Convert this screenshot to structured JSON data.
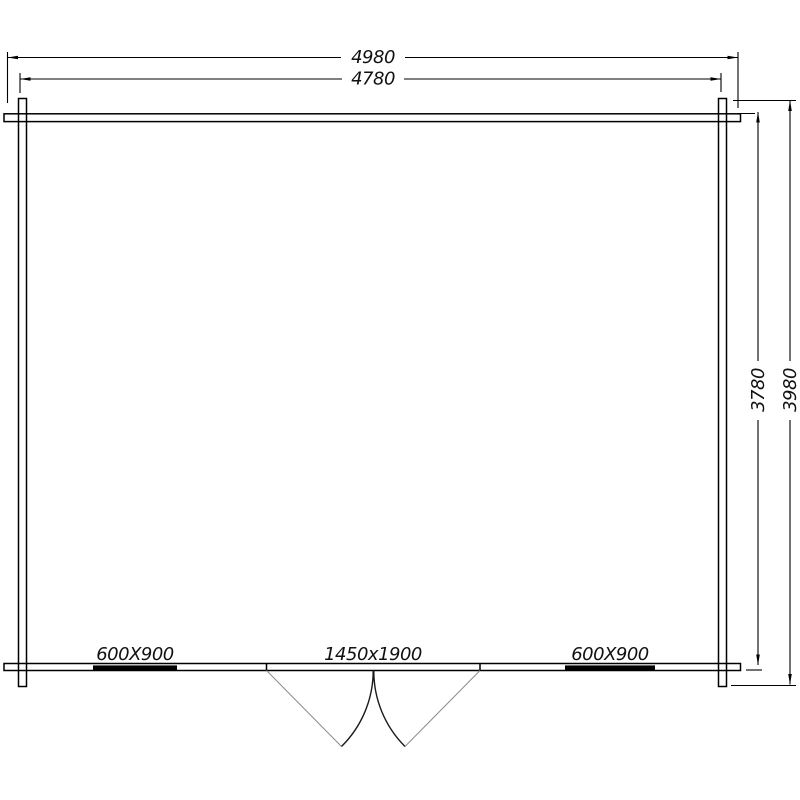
{
  "dimensions": {
    "top_outer": "4980",
    "top_inner": "4780",
    "right_inner": "3780",
    "right_outer": "3980"
  },
  "openings": {
    "window_left": "600X900",
    "door": "1450x1900",
    "window_right": "600X900"
  },
  "colors": {
    "ink": "#000000",
    "door_leaf": "#8c8c8c",
    "background": "#ffffff"
  }
}
